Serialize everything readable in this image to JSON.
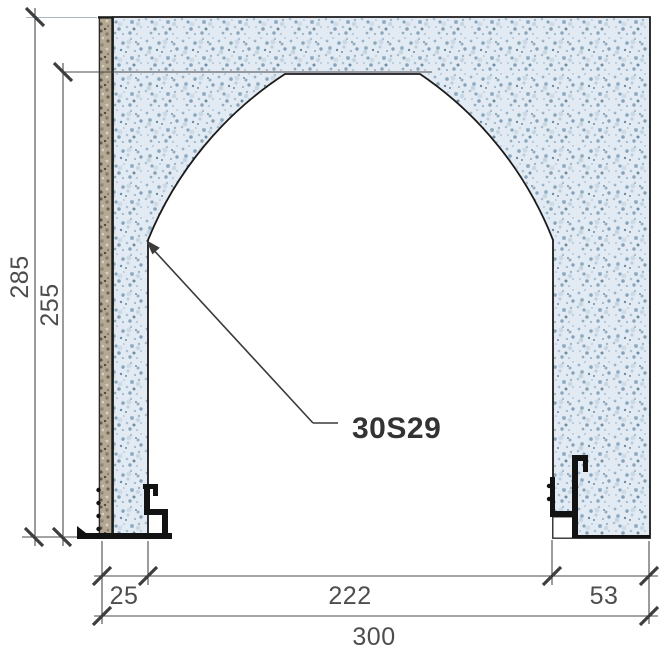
{
  "drawing": {
    "component_label": "30S29",
    "dimensions": {
      "total_height": "285",
      "opening_height": "255",
      "left_reveal_width": "25",
      "opening_width": "222",
      "right_pier_width": "53",
      "total_width": "300"
    },
    "colors": {
      "concrete_base": "#e2ebf3",
      "concrete_speckle": "#93aec3",
      "plaster_base": "#b2a894",
      "outline": "#1b1b1b",
      "dim_line": "#4a4a4a",
      "dim_text": "#4d4d4d",
      "label_text": "#333333",
      "profile_black": "#121212",
      "light_ext_line": "#a9b8c6"
    }
  }
}
